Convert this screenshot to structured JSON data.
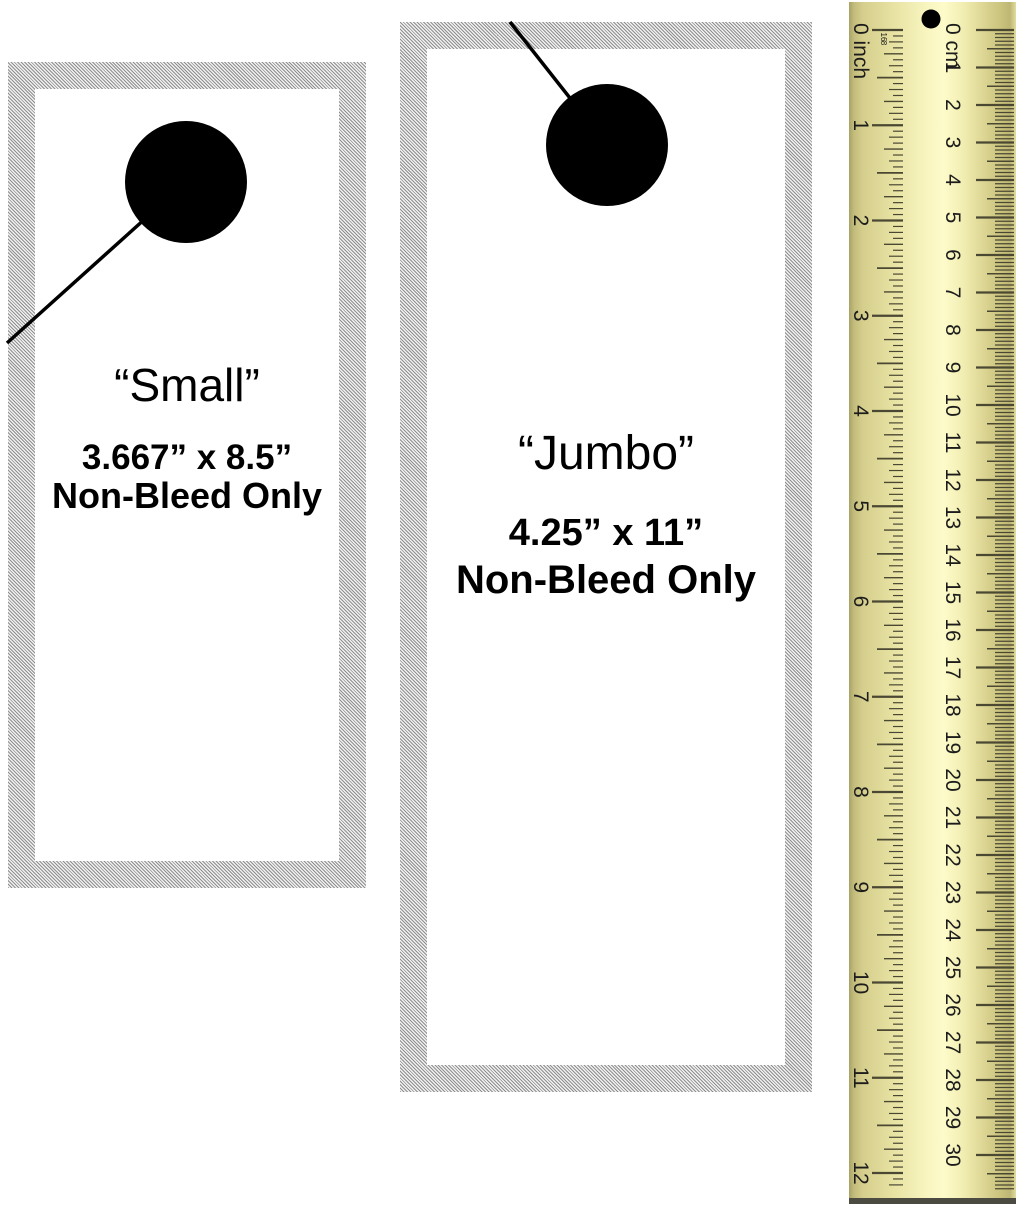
{
  "page": {
    "title": "Door hanger size templates with ruler"
  },
  "hangers": [
    {
      "id": "small",
      "title": "“Small”",
      "dimensions": "3.667” x 8.5”",
      "note": "Non-Bleed Only"
    },
    {
      "id": "jumbo",
      "title": "“Jumbo”",
      "dimensions": "4.25” x 11”",
      "note": "Non-Bleed Only"
    }
  ],
  "ruler": {
    "inch": {
      "zero_label": "0 inch",
      "sub_labels": [
        "16",
        "8"
      ],
      "numbers": [
        1,
        2,
        3,
        4,
        5,
        6,
        7,
        8,
        9,
        10,
        11,
        12
      ],
      "units": 12,
      "divisions_per_unit": 16
    },
    "cm": {
      "zero_label": "0 cm",
      "numbers": [
        1,
        2,
        3,
        4,
        5,
        6,
        7,
        8,
        9,
        10,
        11,
        12,
        13,
        14,
        15,
        16,
        17,
        18,
        19,
        20,
        21,
        22,
        23,
        24,
        25,
        26,
        27,
        28,
        29,
        30
      ],
      "units": 30,
      "divisions_per_unit": 10
    }
  },
  "colors": {
    "hatch_gray": "#8f8f8f",
    "card_white": "#ffffff",
    "ink": "#000000",
    "ruler_body_light": "#fdfbca",
    "ruler_body_dark": "#c3bc7c",
    "ruler_cap": "#4b4b41",
    "ruler_tick": "#4a4733",
    "hole_black": "#000000"
  }
}
